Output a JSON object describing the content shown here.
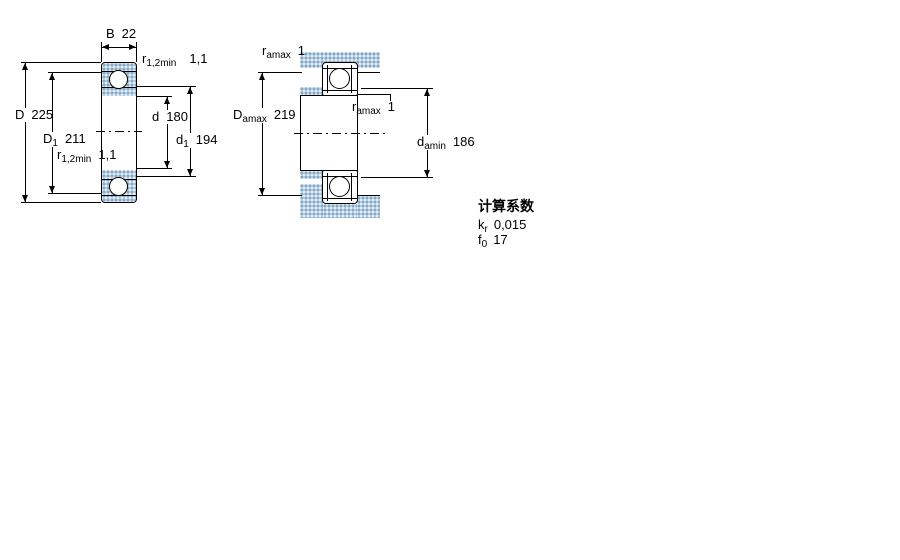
{
  "figure_bearing": {
    "dim_B": {
      "symbol": "B",
      "value": "22"
    },
    "dim_r_top": {
      "symbol": "r",
      "subscript": "1,2min",
      "value": "1,1"
    },
    "dim_D": {
      "symbol": "D",
      "value": "225"
    },
    "dim_D1": {
      "symbol": "D",
      "subscript": "1",
      "value": "211"
    },
    "dim_r_bottom": {
      "symbol": "r",
      "subscript": "1,2min",
      "value": "1,1"
    },
    "dim_d": {
      "symbol": "d",
      "value": "180"
    },
    "dim_d1": {
      "symbol": "d",
      "subscript": "1",
      "value": "194"
    }
  },
  "figure_mounting": {
    "dim_r_housing": {
      "symbol": "r",
      "subscript": "amax",
      "value": "1"
    },
    "dim_Damax": {
      "symbol": "D",
      "subscript": "amax",
      "value": "219"
    },
    "dim_r_shaft": {
      "symbol": "r",
      "subscript": "amax",
      "value": "1"
    },
    "dim_damin": {
      "symbol": "d",
      "subscript": "amin",
      "value": "186"
    }
  },
  "calculation_factors": {
    "title": "计算系数",
    "rows": [
      {
        "symbol": "k",
        "subscript": "r",
        "value": "0,015"
      },
      {
        "symbol": "f",
        "subscript": "0",
        "value": "17"
      }
    ]
  },
  "colors": {
    "steel_fill": "#b0cbe2",
    "line": "#000000",
    "background": "#ffffff"
  }
}
